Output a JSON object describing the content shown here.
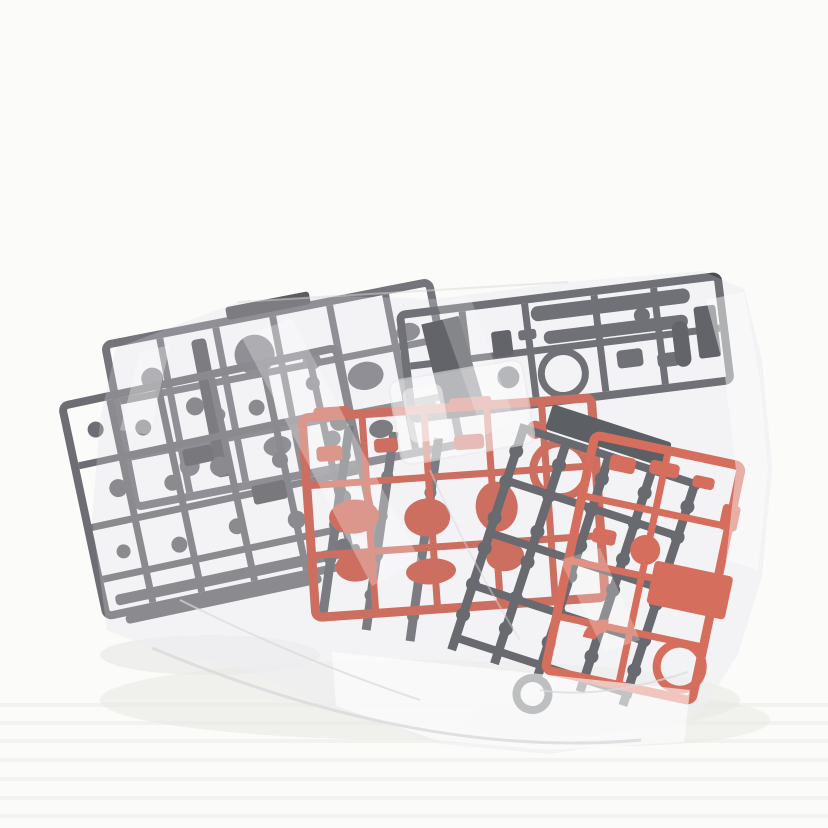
{
  "scene": {
    "kind": "product-photo",
    "subject": "Unassembled plastic model kit part runners (sprues) sealed in a clear plastic bag on a white surface",
    "background": {
      "surface": "#fbfbf9",
      "stripe": "#f0efec",
      "shadow": "#e7e7e4"
    },
    "bag": {
      "film": "#edeef1",
      "haze": "#f2f3f5",
      "highlight": "#ffffff",
      "crease": "#d9dadc"
    },
    "inner_bag": {
      "film": "#ffffff",
      "edge": "#e9eaec"
    },
    "runners": {
      "gray_upper": {
        "color": "#74747a",
        "dark": "#5b5b61"
      },
      "gray_lower": {
        "color": "#6d6d73",
        "dark": "#56565c"
      },
      "gray_center": {
        "color": "#5a5b60"
      },
      "weapon": {
        "color": "#4b4e53",
        "dark": "#3a3d42"
      },
      "red_center": {
        "color": "#c34b36",
        "dark": "#a53c2a"
      },
      "polycap": {
        "color": "#42454a",
        "dark": "#33363a"
      },
      "red_right": {
        "color": "#cf4a33",
        "dark": "#ad3a26"
      }
    }
  }
}
